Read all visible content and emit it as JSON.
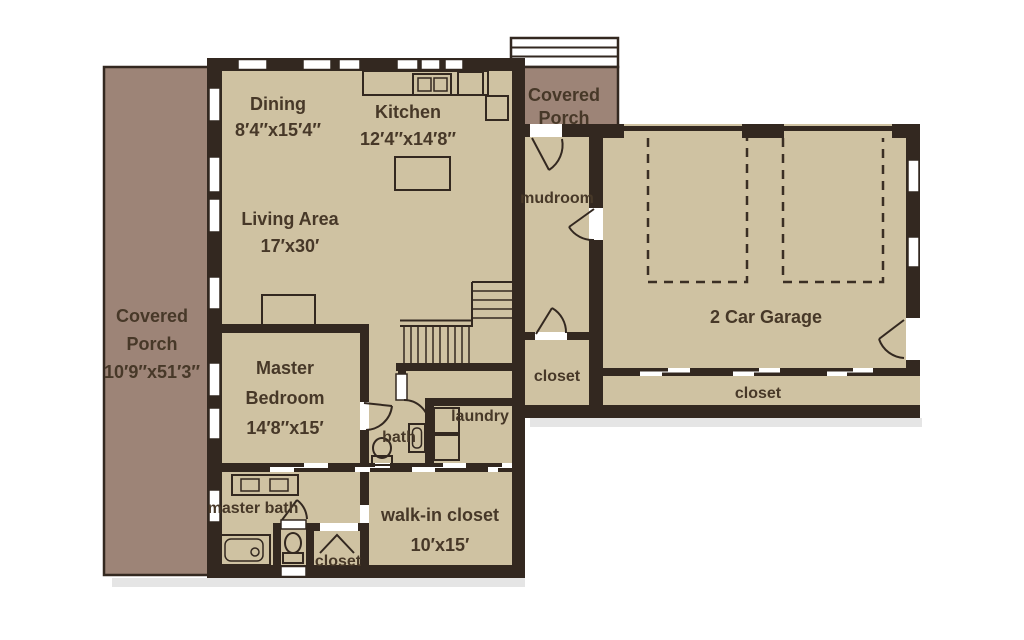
{
  "title": "First floor plan",
  "colors": {
    "background": "#ffffff",
    "floor": "#cfc2a2",
    "porch": "#9d8477",
    "wall": "#332820",
    "text": "#473828",
    "shadow": "#cfcfcf"
  },
  "rooms": {
    "dining": {
      "name": "Dining",
      "dims": "8′4″x15′4″"
    },
    "kitchen": {
      "name": "Kitchen",
      "dims": "12′4″x14′8″"
    },
    "living": {
      "name": "Living Area",
      "dims": "17′x30′"
    },
    "master_bedroom": {
      "name_line1": "Master",
      "name_line2": "Bedroom",
      "dims": "14′8″x15′"
    },
    "garage": {
      "name": "2 Car Garage"
    },
    "mudroom": {
      "name": "mudroom"
    },
    "bath": {
      "name": "bath"
    },
    "laundry": {
      "name": "laundry"
    },
    "master_bath": {
      "name": "master bath"
    },
    "walk_in_closet": {
      "name": "walk-in closet",
      "dims": "10′x15′"
    },
    "closet_hall": {
      "name": "closet"
    },
    "closet_garage": {
      "name": "closet"
    },
    "closet_master": {
      "name": "closet"
    },
    "porch_left": {
      "name_line1": "Covered",
      "name_line2": "Porch",
      "dims": "10′9″x51′3″"
    },
    "porch_entry": {
      "name_line1": "Covered",
      "name_line2": "Porch"
    }
  }
}
